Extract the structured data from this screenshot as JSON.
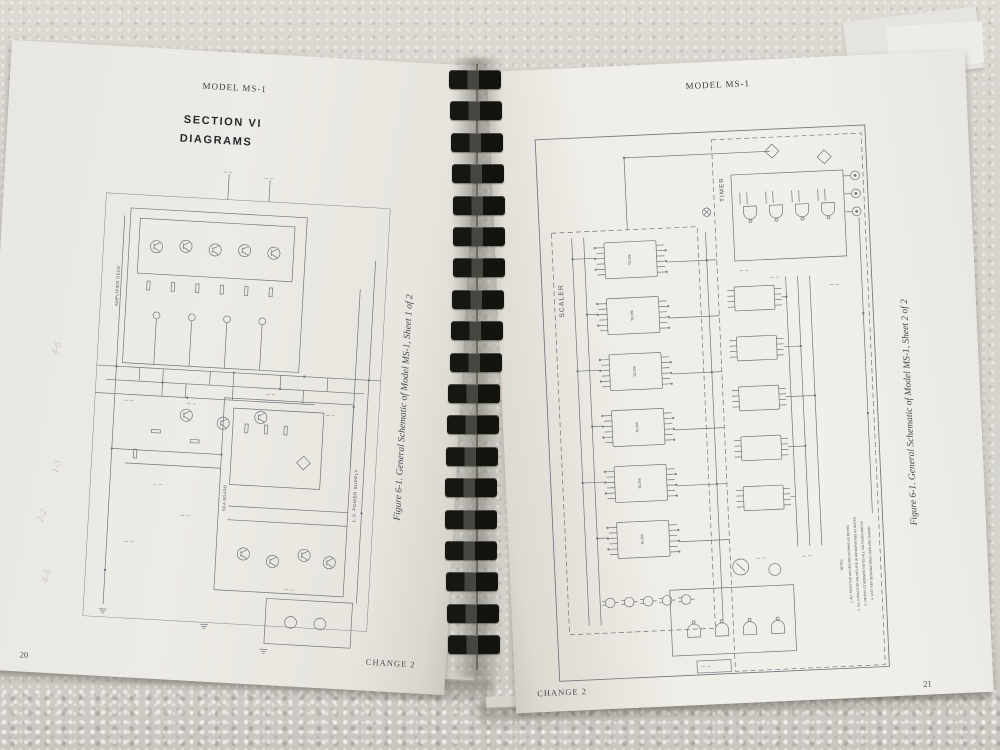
{
  "scene": {
    "wall_color": "#d8d5cf",
    "page_color": "#ebe9e3",
    "schematic_line_color": "#70747c",
    "binding_color": "#1b1b18",
    "shadow_color": "#5a564e"
  },
  "left_page": {
    "header": "MODEL MS-1",
    "section_line1": "SECTION VI",
    "section_line2": "DIAGRAMS",
    "caption": "Figure 6-1.  General Schematic of Model MS-1, Sheet 1 of 2",
    "page_number": "20",
    "change_notice": "CHANGE 2",
    "labels": {
      "amplifier_deck": "AMPLIFIER DECK",
      "sca_board": "SCA BOARD",
      "lv_power_supply": "L.V. POWER SUPPLY"
    },
    "pencil_marks": [
      "4-6",
      "1-3",
      "2-2",
      "4-5"
    ]
  },
  "right_page": {
    "header": "MODEL MS-1",
    "caption": "Figure 6-1.  General Schematic of Model MS-1, Sheet 2 of 2",
    "page_number": "21",
    "change_notice": "CHANGE 2",
    "labels": {
      "scaler": "SCALER",
      "timer": "TIMER"
    },
    "ic_label": "TIL306",
    "notes": [
      "NOTES:",
      "1. ALL RESISTOR VALUES ARE IN OHMS AS NOTED",
      "2. ALL CAPACITOR VALUES ARE IN MICROFARADS AS NOTED",
      "3. UNLESS OTHERWISE NOTED ALL VOLTAGES ARE DC",
      "4. LAST REF DESIGNATIONS USED ARE SHOWN"
    ]
  },
  "binding": {
    "teeth_count": 19
  }
}
